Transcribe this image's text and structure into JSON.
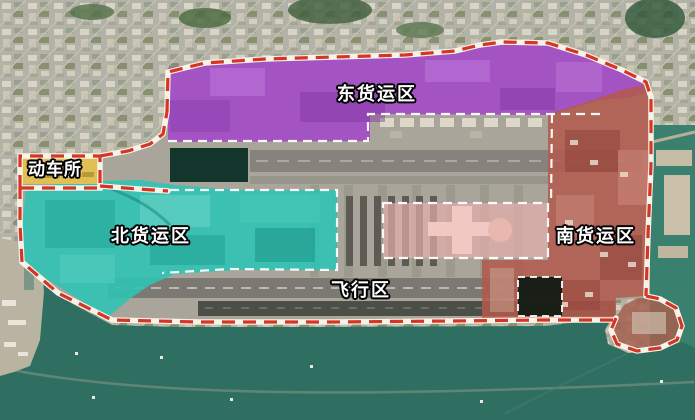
{
  "map": {
    "description": "Satellite annotation map of an airport with functional zone overlays",
    "labels": {
      "east_cargo": "东货运区",
      "emu_depot": "动车所",
      "north_cargo": "北货运区",
      "south_cargo": "南货运区",
      "airfield": "飞行区"
    },
    "zones": [
      {
        "id": "east-cargo",
        "label": "东货运区",
        "color": "#a348c8"
      },
      {
        "id": "north-cargo",
        "label": "北货运区",
        "color": "#2fc3b4"
      },
      {
        "id": "south-cargo",
        "label": "南货运区",
        "color": "#b3594c"
      },
      {
        "id": "airfield",
        "label": "飞行区",
        "color": "#a9a59b"
      },
      {
        "id": "emu-depot",
        "label": "动车所",
        "color": "#e0c055"
      }
    ],
    "boundary": {
      "color": "#d43524",
      "casing": "#f7f3e8",
      "style": "dashed"
    },
    "inner_boundary": {
      "color": "#ffffff",
      "style": "dashed"
    },
    "water_color": "#2f6f62",
    "label_text_color": "#ffffff",
    "label_outline_color": "#000000"
  }
}
